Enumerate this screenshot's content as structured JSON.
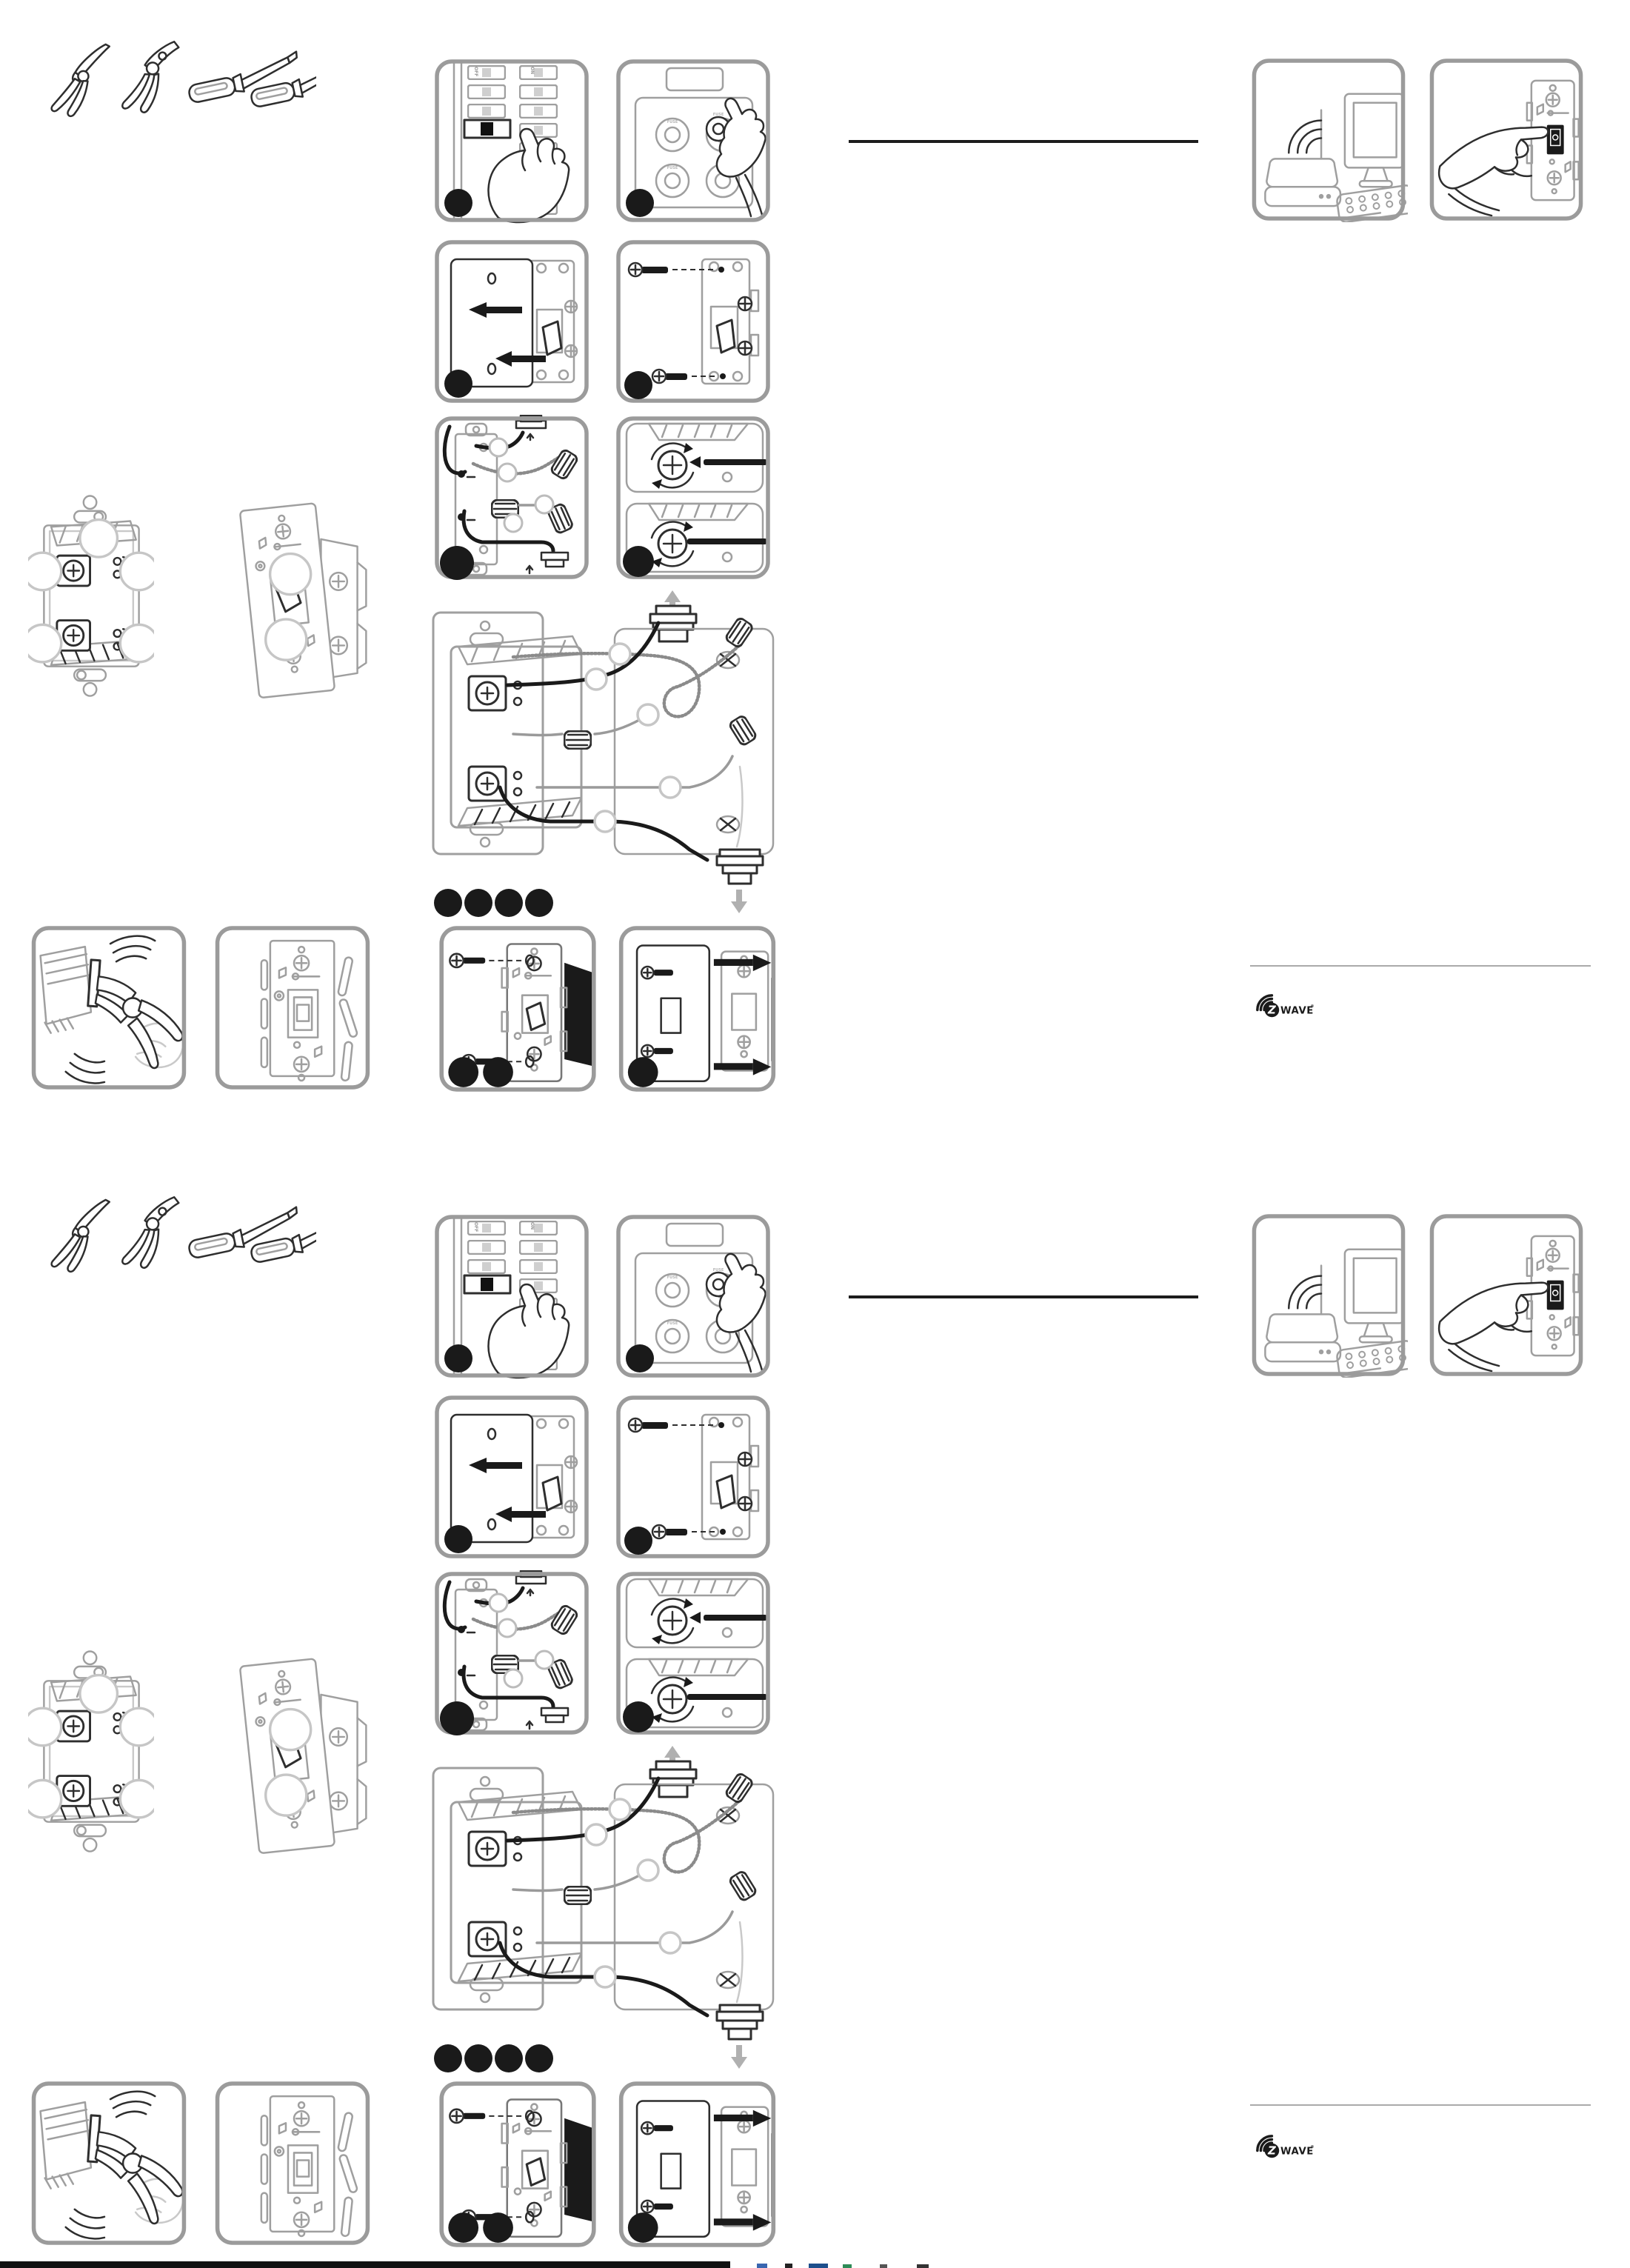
{
  "document": {
    "kind": "printed installation instruction sheet for a Z-Wave smart toggle switch",
    "structure": "two nearly identical illustrated halves (top and bottom), no body text visible"
  },
  "labels": {
    "on": "ON",
    "off": "OFF",
    "fuse": "FUSE"
  },
  "branding": {
    "zwave_z": "Z",
    "zwave_wave": "WAVE",
    "zwave_reg": "®"
  },
  "colors": {
    "page": "#ffffff",
    "line_art": "#2e2e2e",
    "ghost_gray": "#9f9f9f",
    "panel_border": "#9b9b9b",
    "step_dot": "#1a1a1a",
    "divider_black": "#1c1c1c",
    "rule_gray": "#aaaaaa"
  },
  "panel_legend": [
    {
      "id": "tools-illustration",
      "depicts": "needle-nose pliers, lineman pliers, flat screwdriver, phillips screwdriver"
    },
    {
      "id": "panel-breaker-off",
      "depicts": "hand switching a circuit breaker off",
      "step_dots": 1
    },
    {
      "id": "panel-fuse-remove",
      "depicts": "hand removing a fuse from a fuse box",
      "step_dots": 1
    },
    {
      "id": "panel-wallplate-remove",
      "depicts": "removing existing wall plate, two left arrows",
      "step_dots": 1
    },
    {
      "id": "panel-switch-unscrew",
      "depicts": "removing mounting screws from old switch",
      "step_dots": 1
    },
    {
      "id": "panel-wire-prep",
      "depicts": "old switch with wires, wire nuts and callouts",
      "step_dots": 1
    },
    {
      "id": "panel-terminal-screws",
      "depicts": "close-up of terminal screws with rotation arrows and wires",
      "step_dots": 1
    },
    {
      "id": "wiring-diagram",
      "depicts": "smart switch wired to wall box with cable clamps, wire nuts and empty callout circles",
      "step_dots_below": 4
    },
    {
      "id": "panel-mount-screws",
      "depicts": "fastening smart switch into wall box with two screws",
      "step_dots": 2
    },
    {
      "id": "panel-wallplate-attach",
      "depicts": "sliding wall plate onto mounted switch, two right arrows",
      "step_dots": 1
    },
    {
      "id": "panel-pliers-snap",
      "depicts": "pliers wiggling/snapping off a side tab",
      "step_dots": 0
    },
    {
      "id": "panel-plate-tabs",
      "depicts": "switch face with snapped-off tabs floating beside it",
      "step_dots": 0
    },
    {
      "id": "device-back-view",
      "depicts": "rear of smart switch with terminal blocks and five empty callout circles",
      "step_dots": 0
    },
    {
      "id": "device-side-view",
      "depicts": "three-quarter view of smart toggle switch with two empty callout circles",
      "step_dots": 0
    },
    {
      "id": "panel-hub-computer",
      "depicts": "Z-Wave hub/router with wireless waves beside a desktop computer",
      "step_dots": 0
    },
    {
      "id": "panel-hand-press-switch",
      "depicts": "finger pressing the black toggle of the smart switch",
      "step_dots": 0
    }
  ],
  "footer": {
    "trim_bar": "solid black bar along bottom-left page edge",
    "registration_fragments": "tiny multicolored cut-off print marks bottom-center"
  }
}
